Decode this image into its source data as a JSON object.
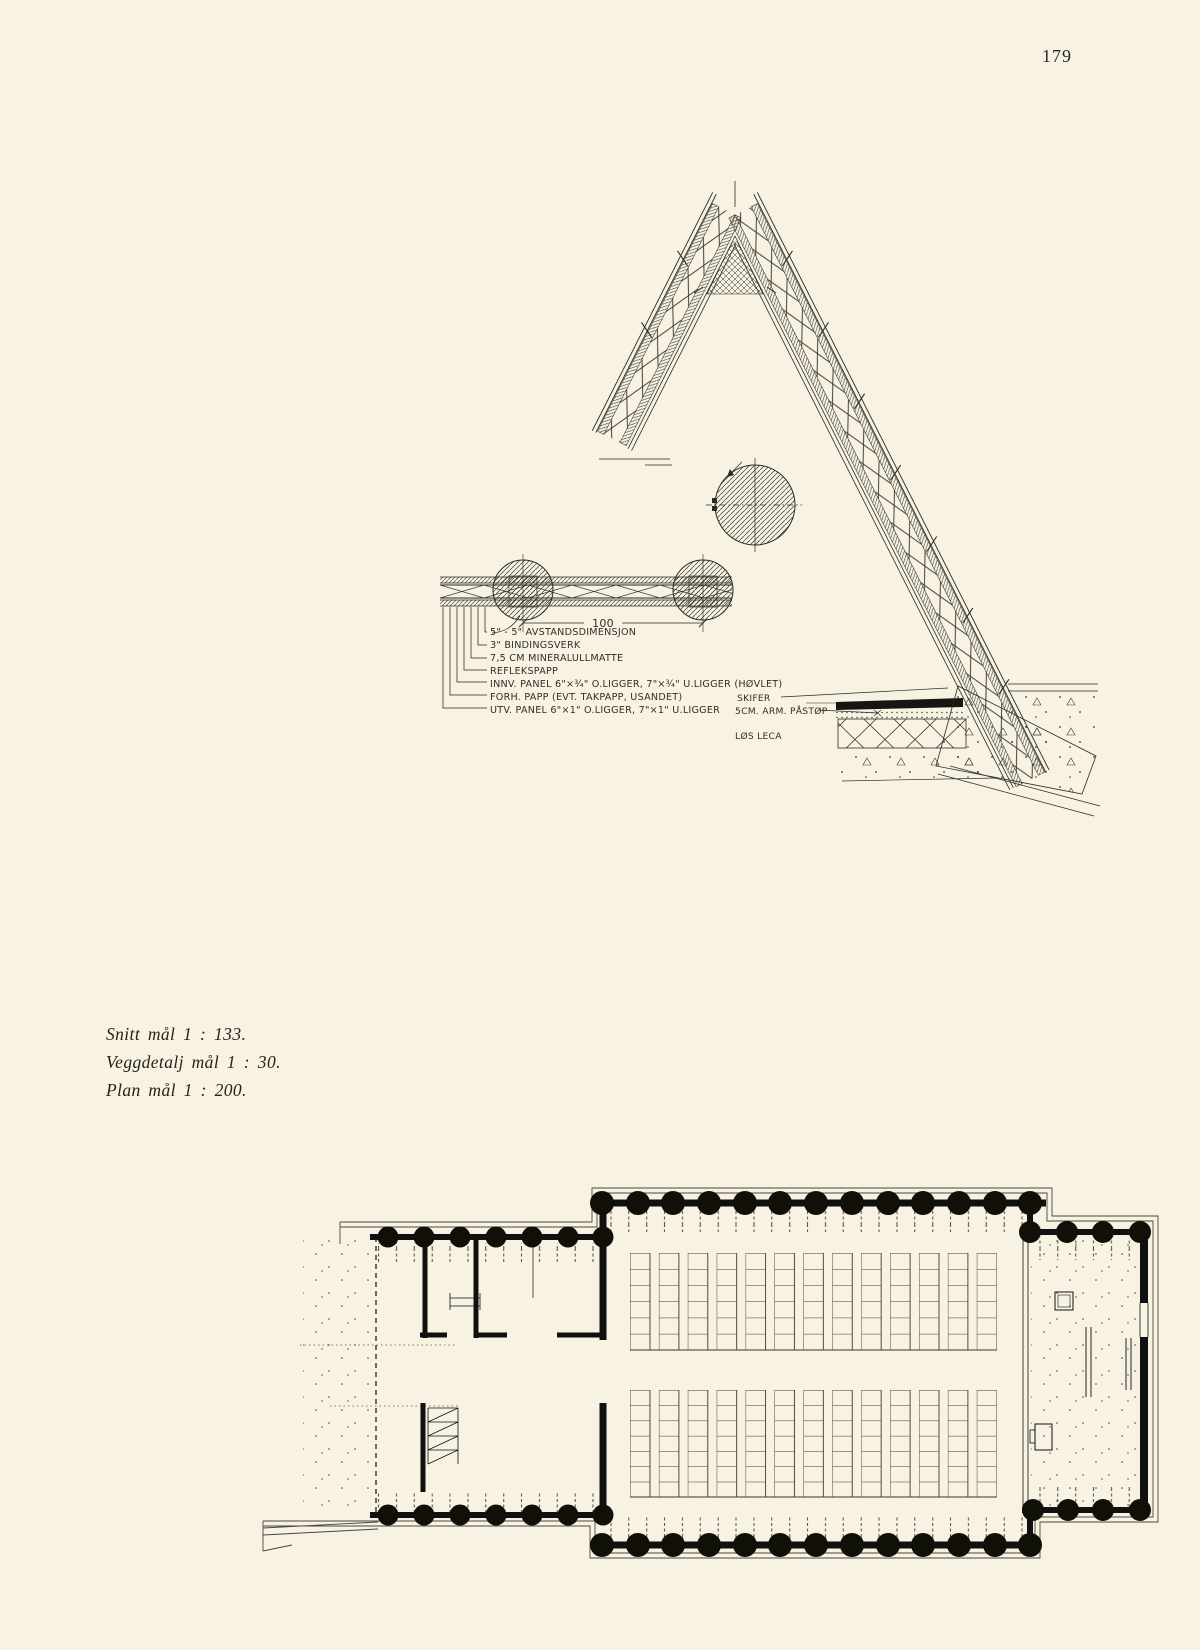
{
  "page": {
    "number": "179"
  },
  "captions": {
    "line1": "Snitt mål 1 : 133.",
    "line2": "Veggdetalj mål 1 : 30.",
    "line3": "Plan mål 1 : 200."
  },
  "section": {
    "dimension": "100",
    "layer_labels": [
      "5\" - 5\" AVSTANDSDIMENSJON",
      "3\" BINDINGSVERK",
      "7,5 CM MINERALULLMATTE",
      "REFLEKSPAPP",
      "INNV. PANEL 6\"×¾\" O.LIGGER, 7\"×¾\" U.LIGGER (HØVLET)",
      "FORH. PAPP (EVT. TAKPAPP, USANDET)",
      "UTV. PANEL 6\"×1\" O.LIGGER, 7\"×1\" U.LIGGER"
    ],
    "foundation_labels": [
      "SKIFER",
      "5CM. ARM. PÅSTØP",
      "LØS LECA"
    ]
  }
}
